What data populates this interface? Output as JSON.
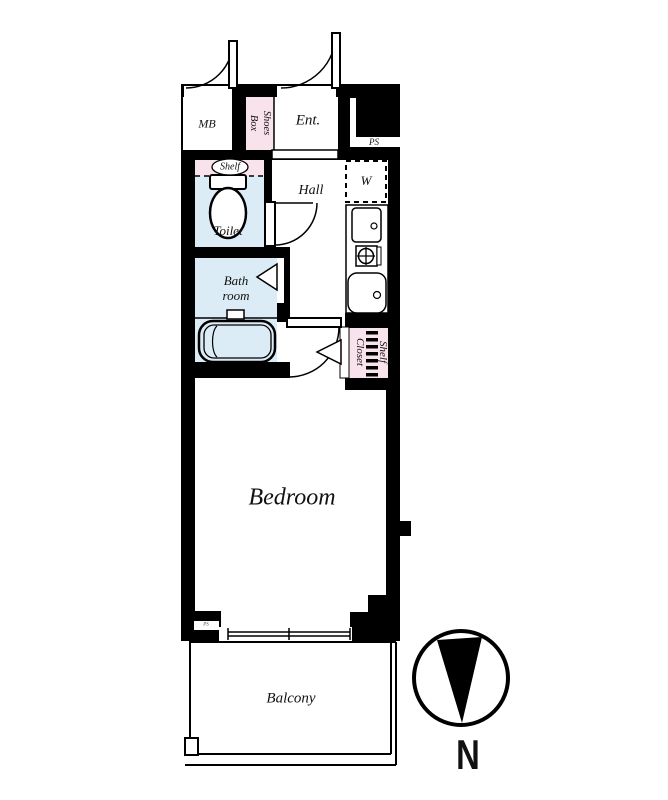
{
  "colors": {
    "wall": "#000000",
    "water_room_fill": "#dcecf6",
    "storage_fill": "#f8e3ec",
    "floor": "#ffffff"
  },
  "labels": {
    "mb": "MB",
    "shoes_box": {
      "line1": "Shoes",
      "line2": "Box"
    },
    "entrance": "Ent.",
    "pipe_shaft": "PS",
    "toilet_shelf": "Shelf",
    "toilet": "Toilet",
    "hall": "Hall",
    "washer": "W",
    "bathroom": {
      "line1": "Bath",
      "line2": "room"
    },
    "shelf_closet": {
      "line1": "Shelf",
      "line2": "Closet"
    },
    "bedroom": "Bedroom",
    "balcony": "Balcony",
    "wall_ps": "PS",
    "compass_north": "N"
  }
}
